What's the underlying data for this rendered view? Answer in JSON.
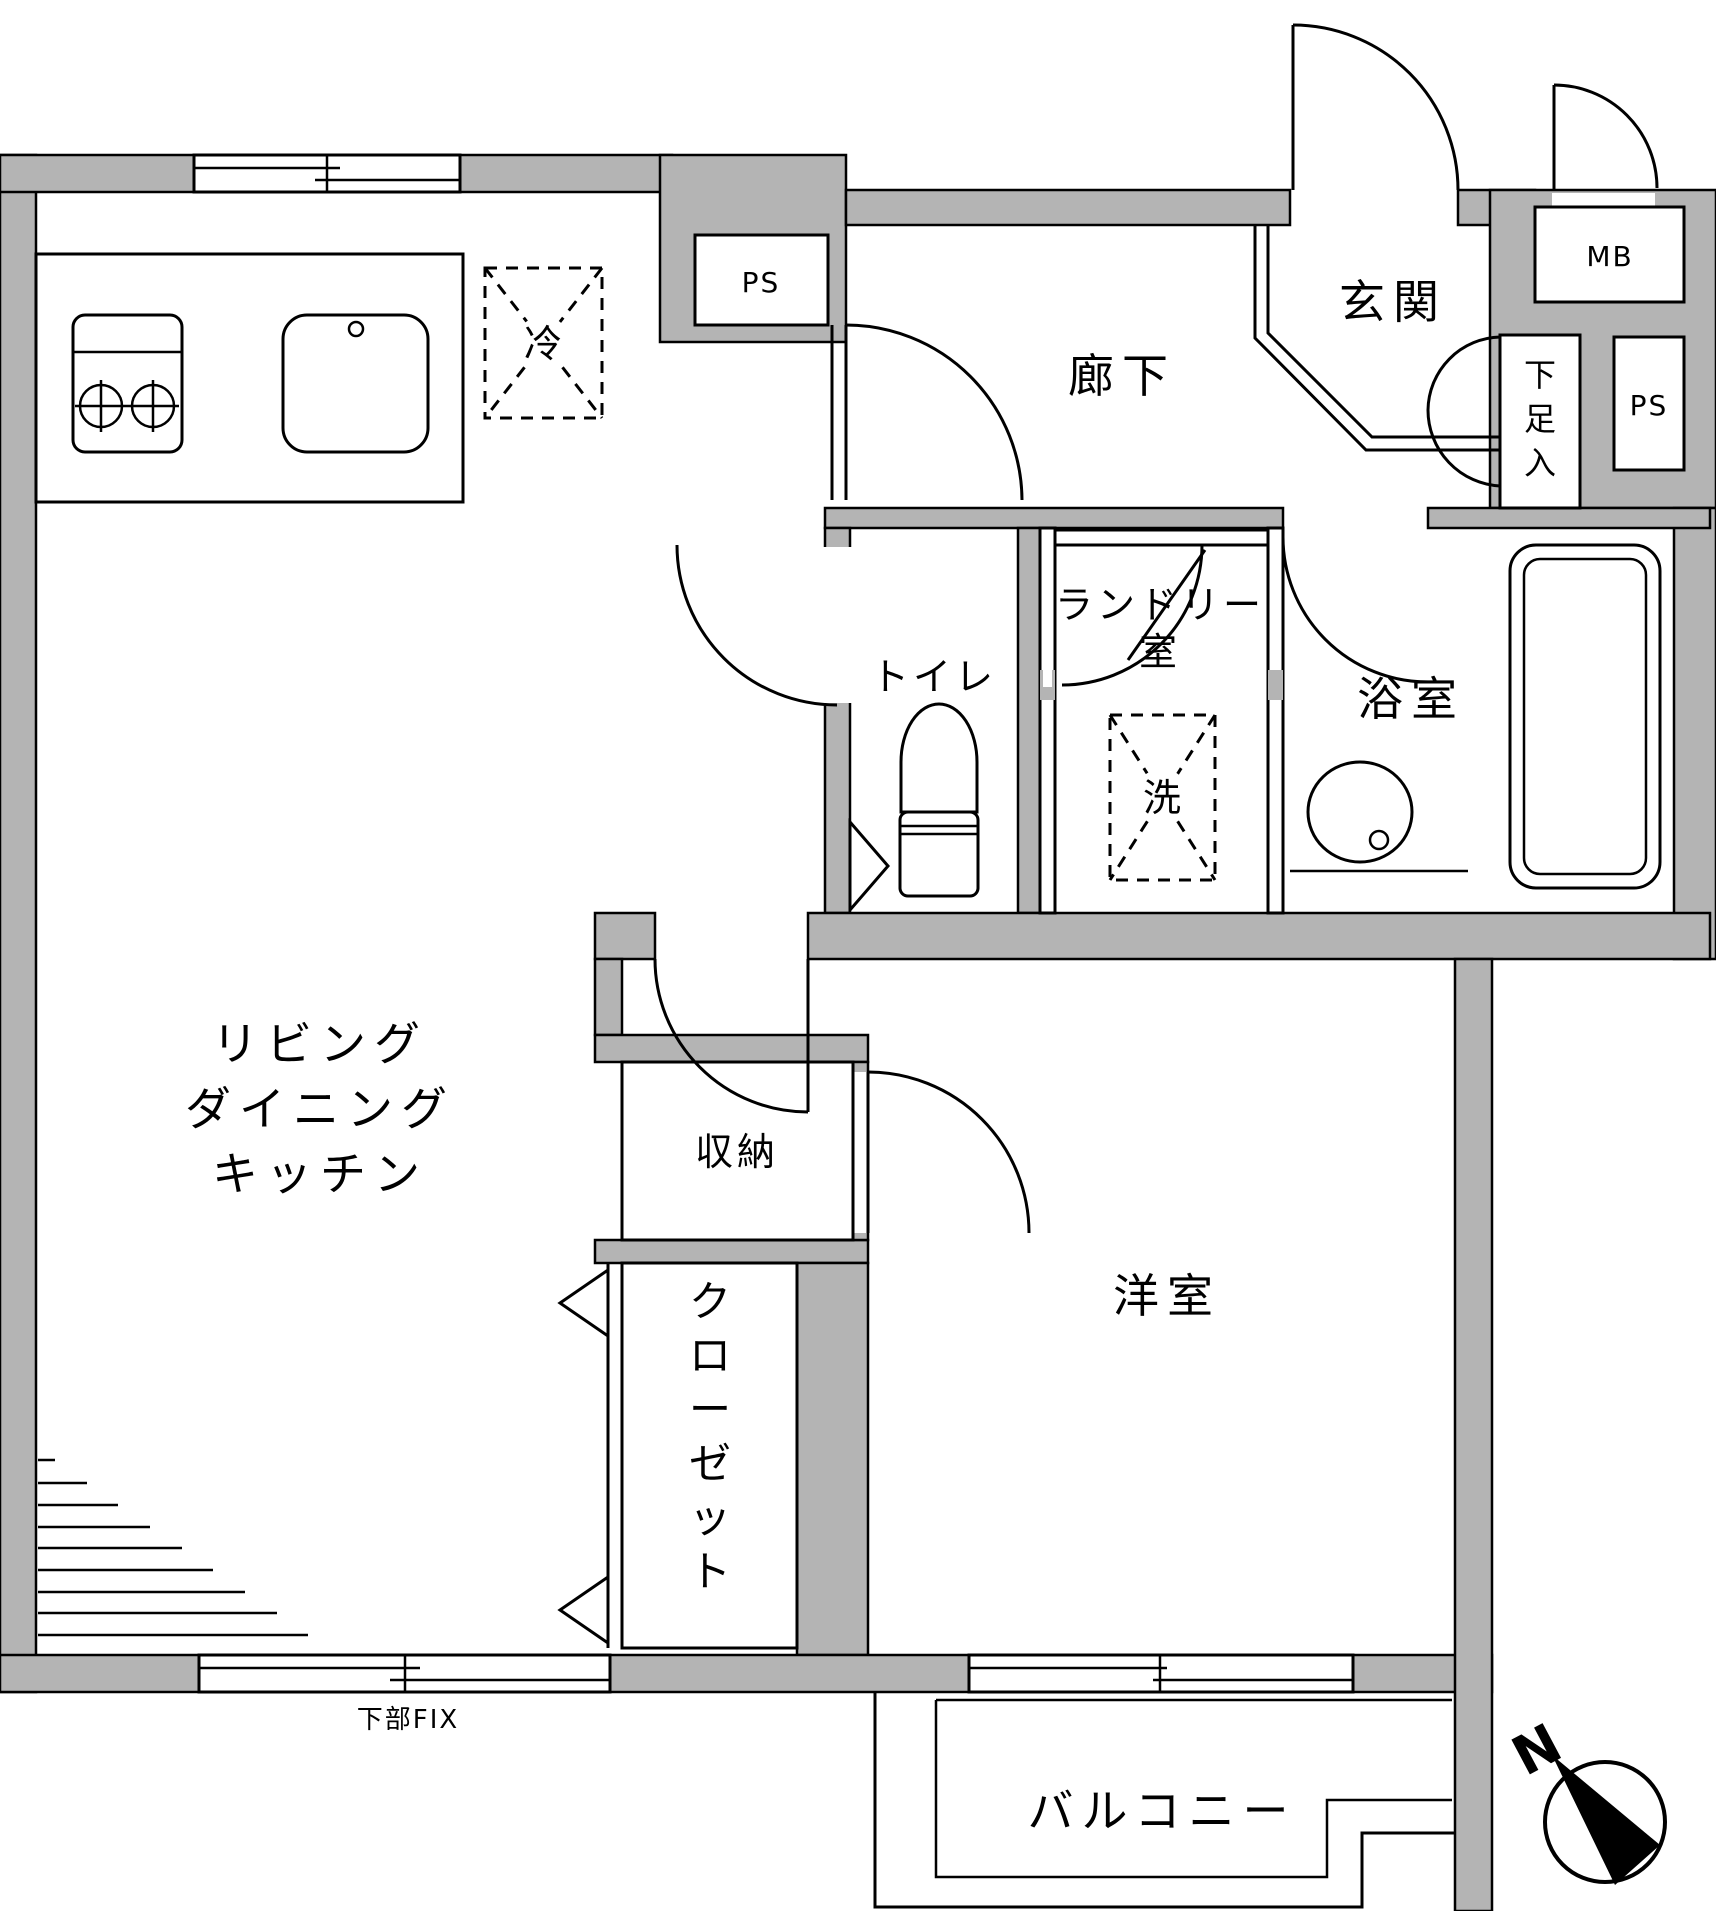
{
  "colors": {
    "wall": "#b4b4b4",
    "line": "#000000",
    "bg": "#ffffff"
  },
  "rooms": {
    "ldk": {
      "line1": "リビング",
      "line2": "ダイニング",
      "line3": "キッチン"
    },
    "hallway": "廊下",
    "entrance": "玄関",
    "toilet": "トイレ",
    "laundry": {
      "line1": "ランドリー",
      "line2": "室"
    },
    "bathroom": "浴室",
    "western_room": "洋室",
    "storage": "収納",
    "closet": "クローゼット",
    "balcony": "バルコニー"
  },
  "fixtures": {
    "fridge": "冷",
    "washer": "洗",
    "meter_box": "MB",
    "pipe_space_top": "PS",
    "pipe_space_right": "PS",
    "shoe_storage": "下足入"
  },
  "annotations": {
    "lower_fix_window": "下部FIX",
    "compass_north": "N"
  }
}
